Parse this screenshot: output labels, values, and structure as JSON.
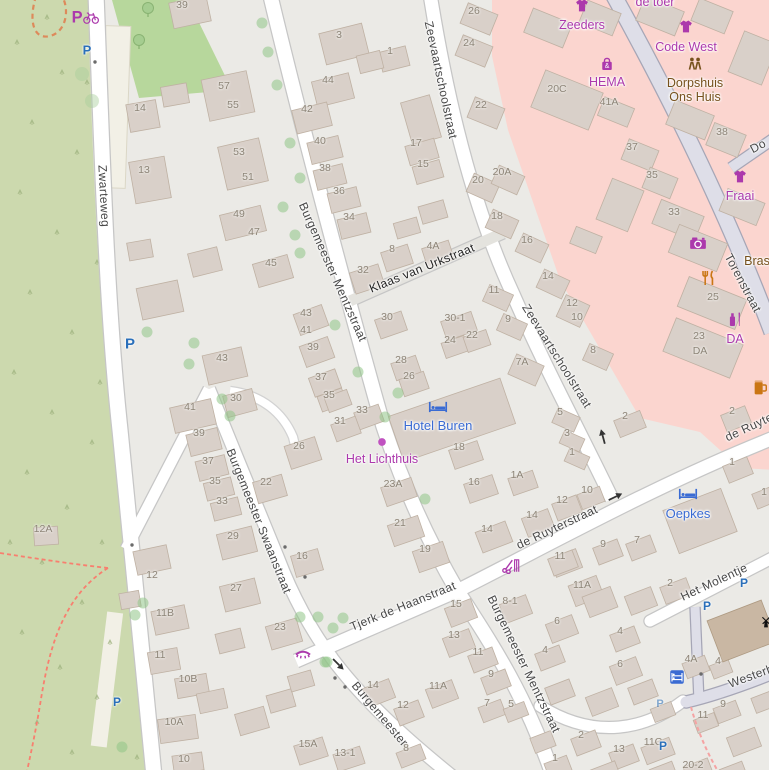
{
  "map": {
    "width": 769,
    "height": 770,
    "locale": "nl"
  },
  "colors": {
    "urban_background": "#ebeae6",
    "scrub_green": "#ccd9ae",
    "park_green": "#b7d79c",
    "retail_pink": "#fbd5cf",
    "building_fill": "#d9d0c9",
    "building_stroke": "#bfb1a3",
    "road_white": "#ffffff",
    "road_casing": "#c8c8c8",
    "pedestrian_road": "#dedee8",
    "shop_label": "#ac39ac",
    "amenity_label": "#76511c",
    "hotel_label": "#3a6bd3",
    "food_icon": "#ca7614",
    "parking_blue": "#2a6fba",
    "house_number": "#8d8477",
    "street_label": "#474747",
    "footpath_dashed": "#f87f6f"
  },
  "street_labels": [
    {
      "text": "Zwarteweg",
      "x": 104,
      "y": 196,
      "rot": 87
    },
    {
      "text": "Burgemeester Mentzstraat",
      "x": 333,
      "y": 272,
      "rot": 66
    },
    {
      "text": "Zeevaartschoolstraat",
      "x": 441,
      "y": 80,
      "rot": 78
    },
    {
      "text": "Zeevaartschoolstraat",
      "x": 557,
      "y": 356,
      "rot": 58
    },
    {
      "text": "Klaas van Urkstraat",
      "x": 422,
      "y": 268,
      "rot": -22,
      "dark": true
    },
    {
      "text": "Burgemeester Swaanstraat",
      "x": 259,
      "y": 521,
      "rot": 68
    },
    {
      "text": "Tjerk de Haanstraat",
      "x": 403,
      "y": 606,
      "rot": -22
    },
    {
      "text": "de Ruyterstraat",
      "x": 557,
      "y": 527,
      "rot": -25
    },
    {
      "text": "de Ruyte",
      "x": 749,
      "y": 427,
      "rot": -25
    },
    {
      "text": "Torenstraat",
      "x": 743,
      "y": 283,
      "rot": 62
    },
    {
      "text": "Het Molentje",
      "x": 714,
      "y": 582,
      "rot": -25
    },
    {
      "text": "Westerb",
      "x": 751,
      "y": 676,
      "rot": -20
    },
    {
      "text": "Burgemeester Mentzstraat",
      "x": 524,
      "y": 664,
      "rot": 64
    },
    {
      "text": "Burgemeester",
      "x": 380,
      "y": 714,
      "rot": 50
    },
    {
      "text": "Do",
      "x": 758,
      "y": 146,
      "rot": -28
    }
  ],
  "house_numbers": [
    {
      "t": "39",
      "x": 182,
      "y": 5
    },
    {
      "t": "57",
      "x": 224,
      "y": 86
    },
    {
      "t": "55",
      "x": 233,
      "y": 105
    },
    {
      "t": "14",
      "x": 140,
      "y": 108
    },
    {
      "t": "13",
      "x": 144,
      "y": 170
    },
    {
      "t": "53",
      "x": 239,
      "y": 152
    },
    {
      "t": "51",
      "x": 248,
      "y": 177
    },
    {
      "t": "49",
      "x": 239,
      "y": 214
    },
    {
      "t": "47",
      "x": 254,
      "y": 232
    },
    {
      "t": "45",
      "x": 271,
      "y": 263
    },
    {
      "t": "43",
      "x": 306,
      "y": 313
    },
    {
      "t": "41",
      "x": 306,
      "y": 330
    },
    {
      "t": "39",
      "x": 313,
      "y": 347
    },
    {
      "t": "37",
      "x": 321,
      "y": 377
    },
    {
      "t": "35",
      "x": 329,
      "y": 395
    },
    {
      "t": "43",
      "x": 222,
      "y": 358
    },
    {
      "t": "41",
      "x": 190,
      "y": 407
    },
    {
      "t": "30",
      "x": 236,
      "y": 398
    },
    {
      "t": "39",
      "x": 199,
      "y": 433
    },
    {
      "t": "37",
      "x": 208,
      "y": 461
    },
    {
      "t": "35",
      "x": 215,
      "y": 481
    },
    {
      "t": "33",
      "x": 222,
      "y": 501
    },
    {
      "t": "26",
      "x": 299,
      "y": 446
    },
    {
      "t": "22",
      "x": 266,
      "y": 482
    },
    {
      "t": "3",
      "x": 339,
      "y": 35
    },
    {
      "t": "1",
      "x": 390,
      "y": 51
    },
    {
      "t": "44",
      "x": 328,
      "y": 80
    },
    {
      "t": "42",
      "x": 307,
      "y": 109
    },
    {
      "t": "40",
      "x": 320,
      "y": 141
    },
    {
      "t": "38",
      "x": 325,
      "y": 168
    },
    {
      "t": "36",
      "x": 339,
      "y": 191
    },
    {
      "t": "34",
      "x": 349,
      "y": 217
    },
    {
      "t": "26",
      "x": 474,
      "y": 11
    },
    {
      "t": "24",
      "x": 469,
      "y": 43
    },
    {
      "t": "22",
      "x": 481,
      "y": 105
    },
    {
      "t": "17",
      "x": 416,
      "y": 143
    },
    {
      "t": "15",
      "x": 423,
      "y": 164
    },
    {
      "t": "20",
      "x": 478,
      "y": 180
    },
    {
      "t": "20A",
      "x": 502,
      "y": 172
    },
    {
      "t": "18",
      "x": 497,
      "y": 216
    },
    {
      "t": "8",
      "x": 392,
      "y": 249
    },
    {
      "t": "4A",
      "x": 433,
      "y": 246
    },
    {
      "t": "20C",
      "x": 557,
      "y": 89
    },
    {
      "t": "41A",
      "x": 609,
      "y": 102
    },
    {
      "t": "37",
      "x": 632,
      "y": 147
    },
    {
      "t": "35",
      "x": 652,
      "y": 175
    },
    {
      "t": "38",
      "x": 722,
      "y": 132
    },
    {
      "t": "33",
      "x": 674,
      "y": 212
    },
    {
      "t": "25",
      "x": 713,
      "y": 297
    },
    {
      "t": "23",
      "x": 699,
      "y": 336
    },
    {
      "t": "DA",
      "x": 700,
      "y": 351
    },
    {
      "t": "12",
      "x": 572,
      "y": 303
    },
    {
      "t": "10",
      "x": 577,
      "y": 317
    },
    {
      "t": "8",
      "x": 593,
      "y": 350
    },
    {
      "t": "32",
      "x": 363,
      "y": 270
    },
    {
      "t": "30",
      "x": 387,
      "y": 317
    },
    {
      "t": "30-1",
      "x": 455,
      "y": 318
    },
    {
      "t": "24",
      "x": 450,
      "y": 340
    },
    {
      "t": "22",
      "x": 472,
      "y": 335
    },
    {
      "t": "11",
      "x": 494,
      "y": 290
    },
    {
      "t": "9",
      "x": 508,
      "y": 319
    },
    {
      "t": "28",
      "x": 401,
      "y": 360
    },
    {
      "t": "26",
      "x": 409,
      "y": 376
    },
    {
      "t": "7A",
      "x": 522,
      "y": 362
    },
    {
      "t": "16",
      "x": 527,
      "y": 240
    },
    {
      "t": "14",
      "x": 548,
      "y": 276
    },
    {
      "t": "33",
      "x": 362,
      "y": 410
    },
    {
      "t": "31",
      "x": 340,
      "y": 421
    },
    {
      "t": "5",
      "x": 560,
      "y": 412
    },
    {
      "t": "3",
      "x": 567,
      "y": 433
    },
    {
      "t": "1",
      "x": 572,
      "y": 452
    },
    {
      "t": "18",
      "x": 459,
      "y": 447
    },
    {
      "t": "16",
      "x": 474,
      "y": 482
    },
    {
      "t": "1A",
      "x": 517,
      "y": 475
    },
    {
      "t": "23A",
      "x": 393,
      "y": 484
    },
    {
      "t": "2",
      "x": 625,
      "y": 416
    },
    {
      "t": "2",
      "x": 732,
      "y": 411
    },
    {
      "t": "1",
      "x": 732,
      "y": 462
    },
    {
      "t": "1",
      "x": 764,
      "y": 492
    },
    {
      "t": "7",
      "x": 637,
      "y": 540
    },
    {
      "t": "9",
      "x": 603,
      "y": 544
    },
    {
      "t": "2",
      "x": 670,
      "y": 583
    },
    {
      "t": "11",
      "x": 560,
      "y": 556
    },
    {
      "t": "11A",
      "x": 582,
      "y": 585
    },
    {
      "t": "10",
      "x": 587,
      "y": 490
    },
    {
      "t": "12",
      "x": 562,
      "y": 500
    },
    {
      "t": "14",
      "x": 532,
      "y": 515
    },
    {
      "t": "14",
      "x": 487,
      "y": 529
    },
    {
      "t": "8-1",
      "x": 510,
      "y": 601
    },
    {
      "t": "15",
      "x": 456,
      "y": 604
    },
    {
      "t": "13",
      "x": 454,
      "y": 635
    },
    {
      "t": "11",
      "x": 478,
      "y": 652
    },
    {
      "t": "9",
      "x": 491,
      "y": 674
    },
    {
      "t": "7",
      "x": 487,
      "y": 703
    },
    {
      "t": "5",
      "x": 511,
      "y": 704
    },
    {
      "t": "11A",
      "x": 438,
      "y": 686
    },
    {
      "t": "12",
      "x": 403,
      "y": 705
    },
    {
      "t": "14",
      "x": 373,
      "y": 685
    },
    {
      "t": "8",
      "x": 406,
      "y": 748
    },
    {
      "t": "12A",
      "x": 43,
      "y": 529
    },
    {
      "t": "29",
      "x": 233,
      "y": 536
    },
    {
      "t": "27",
      "x": 236,
      "y": 588
    },
    {
      "t": "12",
      "x": 152,
      "y": 575
    },
    {
      "t": "11B",
      "x": 165,
      "y": 613
    },
    {
      "t": "11",
      "x": 160,
      "y": 655
    },
    {
      "t": "10B",
      "x": 188,
      "y": 679
    },
    {
      "t": "10A",
      "x": 174,
      "y": 722
    },
    {
      "t": "10",
      "x": 184,
      "y": 759
    },
    {
      "t": "16",
      "x": 302,
      "y": 556
    },
    {
      "t": "23",
      "x": 280,
      "y": 627
    },
    {
      "t": "15A",
      "x": 308,
      "y": 744
    },
    {
      "t": "13-1",
      "x": 345,
      "y": 753
    },
    {
      "t": "21",
      "x": 400,
      "y": 523
    },
    {
      "t": "19",
      "x": 425,
      "y": 549
    },
    {
      "t": "6",
      "x": 557,
      "y": 621
    },
    {
      "t": "4",
      "x": 620,
      "y": 631
    },
    {
      "t": "4",
      "x": 545,
      "y": 650
    },
    {
      "t": "6",
      "x": 620,
      "y": 664
    },
    {
      "t": "4A",
      "x": 691,
      "y": 659
    },
    {
      "t": "4",
      "x": 718,
      "y": 661
    },
    {
      "t": "9",
      "x": 723,
      "y": 704
    },
    {
      "t": "11",
      "x": 703,
      "y": 715
    },
    {
      "t": "2",
      "x": 581,
      "y": 735
    },
    {
      "t": "13",
      "x": 619,
      "y": 749
    },
    {
      "t": "11C",
      "x": 653,
      "y": 742
    },
    {
      "t": "20-2",
      "x": 693,
      "y": 765
    },
    {
      "t": "1",
      "x": 555,
      "y": 758
    }
  ],
  "pois": [
    {
      "x": 85,
      "y": 16,
      "icon": "parking-bike-icon"
    },
    {
      "x": 87,
      "y": 50,
      "icon": "parking-icon",
      "fs": 13
    },
    {
      "x": 130,
      "y": 344,
      "icon": "parking-icon",
      "fs": 15
    },
    {
      "x": 117,
      "y": 702,
      "icon": "parking-icon",
      "fs": 12
    },
    {
      "x": 660,
      "y": 704,
      "icon": "parking-icon",
      "fs": 11,
      "opacity": 0.55
    },
    {
      "x": 744,
      "y": 583,
      "icon": "parking-icon",
      "fs": 12
    },
    {
      "x": 707,
      "y": 606,
      "icon": "parking-icon",
      "fs": 12
    },
    {
      "x": 663,
      "y": 746,
      "icon": "parking-icon",
      "fs": 12
    },
    {
      "x": 582,
      "y": 6,
      "icon": "tshirt-icon",
      "label": "Zeeders",
      "label_dy": 12,
      "color": "shop"
    },
    {
      "x": 655,
      "y": 3,
      "label": "de toer",
      "label_dy": -8,
      "color": "shop"
    },
    {
      "x": 686,
      "y": 27,
      "icon": "tshirt-icon",
      "label": "Code West",
      "label_dy": 13,
      "color": "shop"
    },
    {
      "x": 607,
      "y": 64,
      "icon": "bag-icon",
      "label": "HEMA",
      "label_dy": 11,
      "color": "shop"
    },
    {
      "x": 695,
      "y": 64,
      "icon": "people-icon",
      "label": "Dorpshuis\nOns Huis",
      "label_dy": 12,
      "color": "amenity"
    },
    {
      "x": 740,
      "y": 177,
      "icon": "tshirt-icon",
      "label": "Fraai",
      "label_dy": 12,
      "color": "shop"
    },
    {
      "x": 698,
      "y": 243,
      "icon": "camera-icon"
    },
    {
      "x": 709,
      "y": 278,
      "icon": "restaurant-icon"
    },
    {
      "x": 735,
      "y": 319,
      "icon": "chemist-icon",
      "label": "DA",
      "label_dy": 13,
      "color": "shop"
    },
    {
      "x": 760,
      "y": 387,
      "icon": "beer-icon"
    },
    {
      "x": 757,
      "y": 262,
      "label": "Bras",
      "label_dy": -8,
      "color": "amenity"
    },
    {
      "x": 438,
      "y": 407,
      "icon": "bed-icon",
      "label": "Hotel Buren",
      "label_dy": 12,
      "color": "hotel"
    },
    {
      "x": 688,
      "y": 494,
      "icon": "bed-icon",
      "label": "Oepkes",
      "label_dy": 13,
      "color": "hotel"
    },
    {
      "x": 677,
      "y": 677,
      "icon": "hostel-icon"
    },
    {
      "x": 382,
      "y": 442,
      "icon": "dot-icon",
      "label": "Het Lichthuis",
      "label_dy": 10,
      "color": "shop"
    },
    {
      "x": 303,
      "y": 654,
      "icon": "eyelash-icon"
    },
    {
      "x": 511,
      "y": 566,
      "icon": "hairdresser-icon"
    },
    {
      "x": 766,
      "y": 622,
      "icon": "mill-icon"
    }
  ],
  "oneway_arrows": [
    {
      "x": 603,
      "y": 437,
      "rot": -15
    },
    {
      "x": 615,
      "y": 497,
      "rot": 64
    },
    {
      "x": 338,
      "y": 664,
      "rot": 135
    }
  ],
  "trees": [
    {
      "x": 262,
      "y": 23
    },
    {
      "x": 268,
      "y": 52
    },
    {
      "x": 277,
      "y": 85
    },
    {
      "x": 290,
      "y": 143
    },
    {
      "x": 300,
      "y": 178
    },
    {
      "x": 283,
      "y": 207
    },
    {
      "x": 295,
      "y": 235
    },
    {
      "x": 300,
      "y": 253
    },
    {
      "x": 147,
      "y": 332
    },
    {
      "x": 194,
      "y": 343
    },
    {
      "x": 189,
      "y": 364
    },
    {
      "x": 222,
      "y": 399
    },
    {
      "x": 230,
      "y": 416
    },
    {
      "x": 335,
      "y": 325
    },
    {
      "x": 358,
      "y": 372
    },
    {
      "x": 398,
      "y": 393
    },
    {
      "x": 385,
      "y": 417
    },
    {
      "x": 425,
      "y": 499
    },
    {
      "x": 300,
      "y": 617
    },
    {
      "x": 318,
      "y": 617
    },
    {
      "x": 343,
      "y": 618
    },
    {
      "x": 333,
      "y": 628
    },
    {
      "x": 327,
      "y": 662
    },
    {
      "x": 143,
      "y": 603
    },
    {
      "x": 135,
      "y": 615
    },
    {
      "x": 122,
      "y": 747
    },
    {
      "x": 325,
      "y": 662
    },
    {
      "x": 82,
      "y": 74,
      "pale": true
    },
    {
      "x": 92,
      "y": 101,
      "pale": true
    }
  ],
  "park_trees": [
    {
      "x": 148,
      "y": 8
    },
    {
      "x": 139,
      "y": 40
    }
  ],
  "bollards": [
    {
      "x": 95,
      "y": 62
    },
    {
      "x": 132,
      "y": 545
    },
    {
      "x": 285,
      "y": 547
    },
    {
      "x": 305,
      "y": 577
    },
    {
      "x": 335,
      "y": 678
    },
    {
      "x": 345,
      "y": 687
    },
    {
      "x": 701,
      "y": 674
    }
  ]
}
